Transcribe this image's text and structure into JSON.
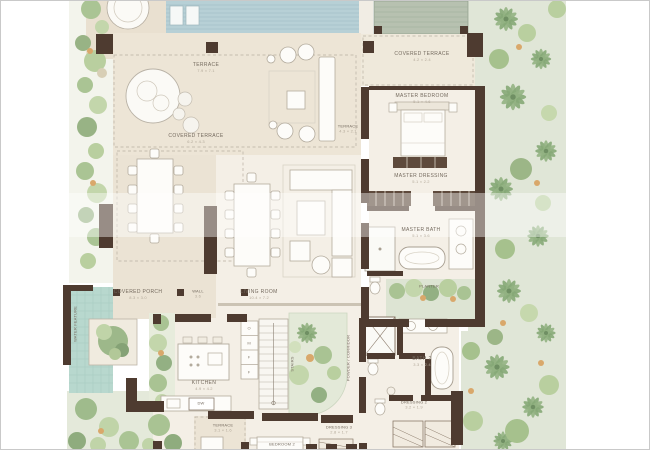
{
  "palette": {
    "wall": "#4e3b30",
    "interior_floor": "#f4efe6",
    "terrace_floor": "#ede5d6",
    "garden": "#e0e6d7",
    "pool": "#b7d0d6",
    "water_feature": "#b8d8ce",
    "roof_hatch": "#b7c1b0",
    "label_text": "#746a5e",
    "dim_text": "#b2a899"
  },
  "rooms": [
    {
      "label": "TERRACE",
      "dim": "7.9 × 7.1"
    },
    {
      "label": "COVERED TERRACE",
      "dim": "6.2 × 4.3"
    },
    {
      "label": "TERRACE",
      "dim": "4.3 × 2.1"
    },
    {
      "label": "COVERED TERRACE",
      "dim": "4.2 × 2.4"
    },
    {
      "label": "MASTER BEDROOM",
      "dim": "5.1 × 4.6"
    },
    {
      "label": "MASTER DRESSING",
      "dim": "5.1 × 2.2"
    },
    {
      "label": "MASTER BATH",
      "dim": "5.1 × 3.6"
    },
    {
      "label": "PLANTER",
      "dim": ""
    },
    {
      "label": "WALL",
      "dim": "3.6"
    },
    {
      "label": "LIVING ROOM",
      "dim": "10.4 × 7.2"
    },
    {
      "label": "COVERED PORCH",
      "dim": "8.3 × 3.0"
    },
    {
      "label": "WATER FEATURE",
      "dim": ""
    },
    {
      "label": "KITCHEN",
      "dim": "4.9 × 4.2"
    },
    {
      "label": "DW",
      "dim": ""
    },
    {
      "label": "STAIRS",
      "dim": ""
    },
    {
      "label": "POWDER / CORRIDOR",
      "dim": ""
    },
    {
      "label": "BATH 2",
      "dim": "3.3 × 2.4"
    },
    {
      "label": "DRESSING 2",
      "dim": "3.2 × 1.9"
    },
    {
      "label": "DRESSING 3",
      "dim": "2.8 × 1.7"
    },
    {
      "label": "BEDROOM 2",
      "dim": "4.5 × 4.0"
    },
    {
      "label": "TERRACE",
      "dim": "3.1 × 1.6"
    }
  ],
  "kitchen_units": [
    "O",
    "M",
    "F",
    "F"
  ]
}
